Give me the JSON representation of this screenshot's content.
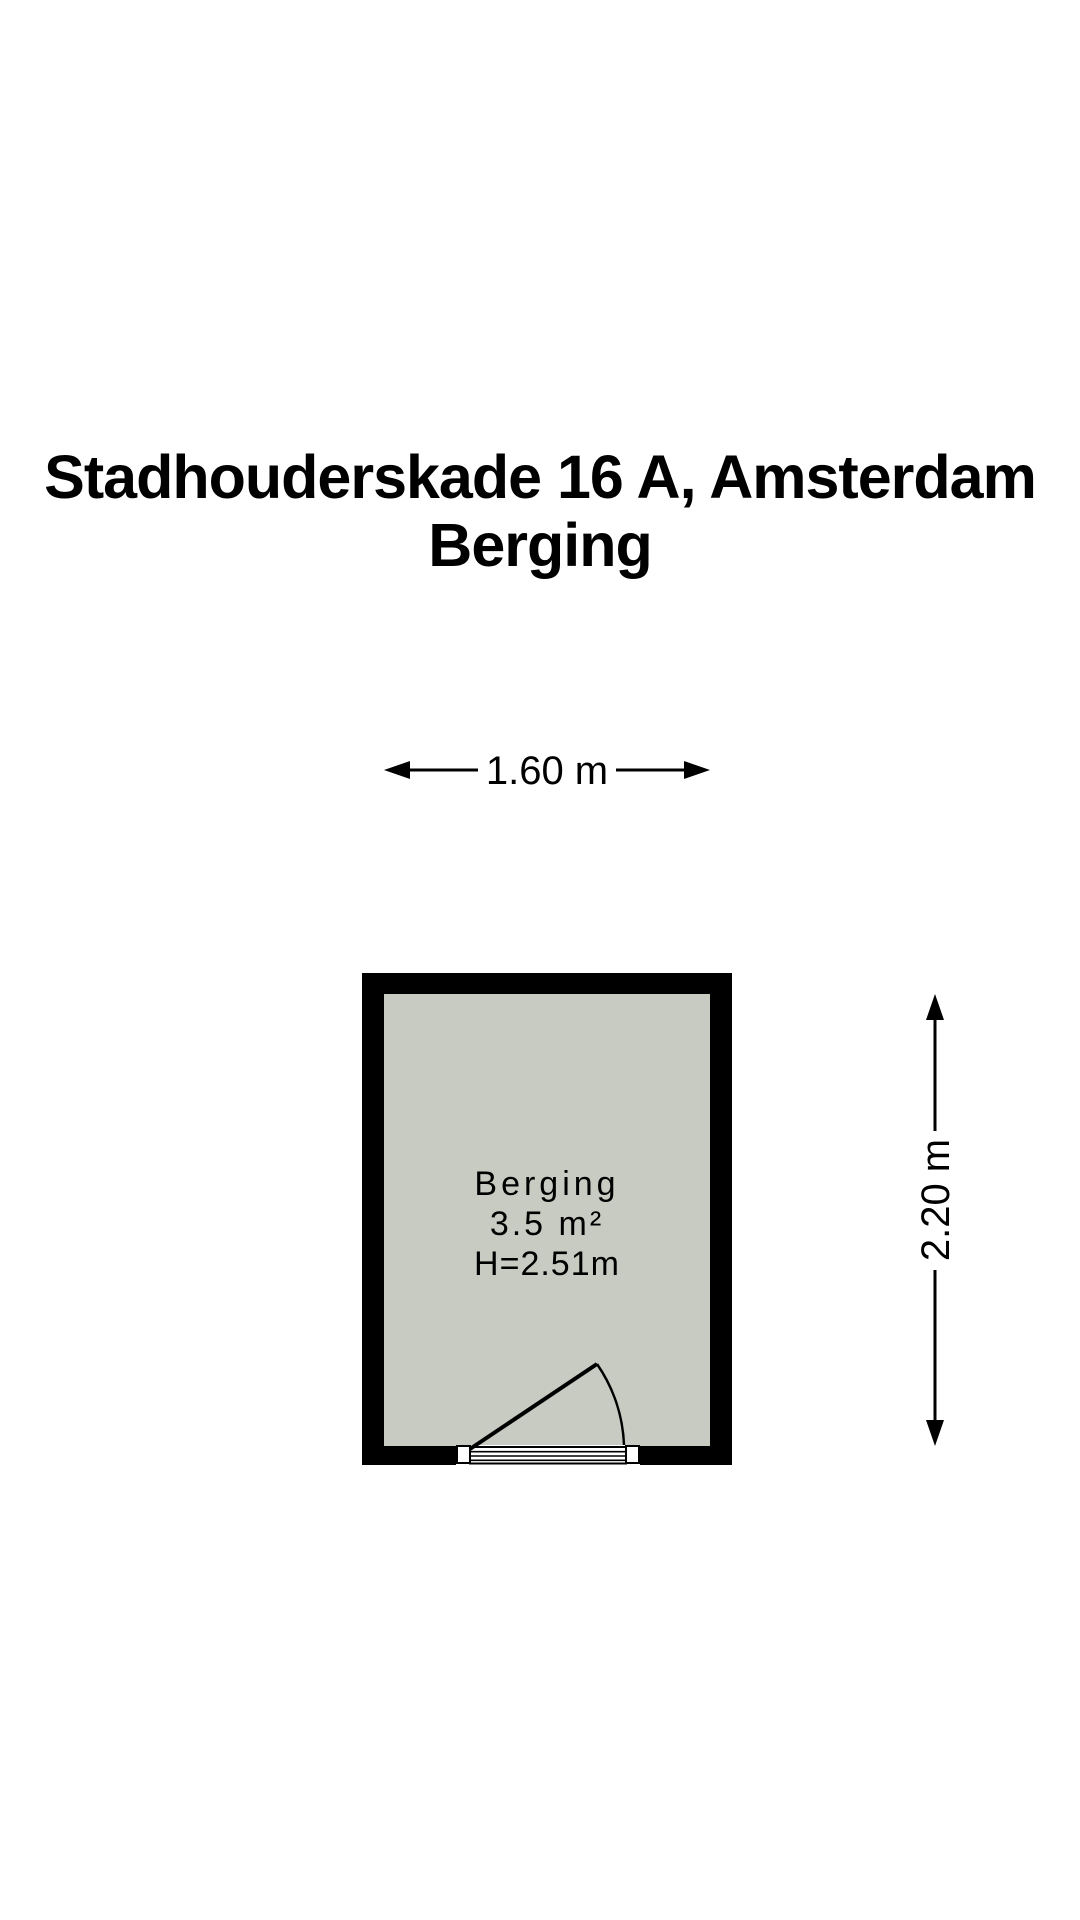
{
  "title": {
    "line1": "Stadhouderskade 16 A, Amsterdam",
    "line2": "Berging"
  },
  "dimensions": {
    "width_label": "1.60 m",
    "height_label": "2.20 m"
  },
  "room": {
    "name": "Berging",
    "area": "3.5 m²",
    "ceiling_height": "H=2.51m"
  },
  "colors": {
    "background": "#ffffff",
    "wall": "#000000",
    "floor": "#c8cbc2",
    "text": "#000000"
  }
}
